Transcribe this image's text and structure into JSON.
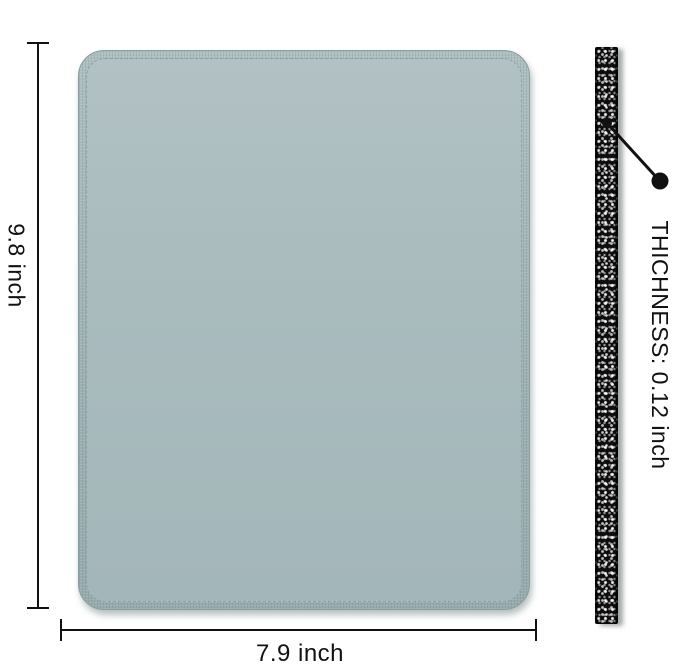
{
  "diagram": {
    "height_label": "9.8 inch",
    "width_label": "7.9 inch",
    "thickness_label": "THICHNESS: 0.12 inch",
    "colors": {
      "background": "#ffffff",
      "pad_fill": "#a3b6b9",
      "pad_fill_light": "#b2c2c4",
      "pad_edge_band": "#9db0b2",
      "pad_stitch": "#8ba3a5",
      "pad_outline": "#879ea0",
      "strip_base": "#0d0d0d",
      "strip_speckle": "#ffffff",
      "dimension_line": "#111111"
    }
  }
}
